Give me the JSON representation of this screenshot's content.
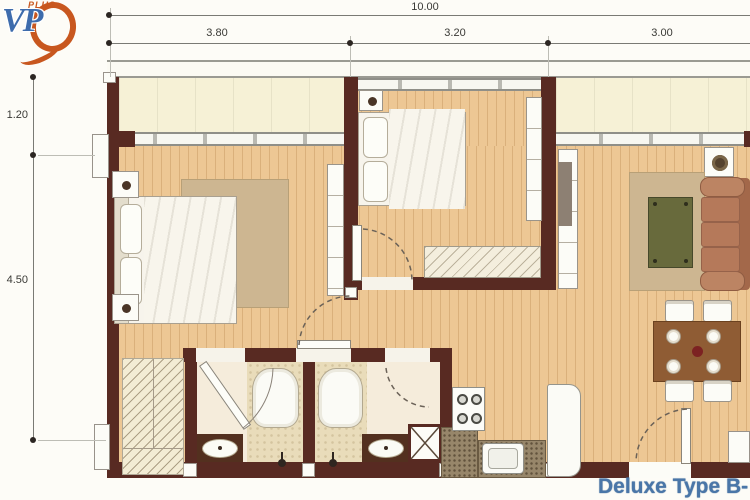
{
  "logo": {
    "vp_text": "VP",
    "plus_text": "PLUS"
  },
  "plan_title": "Deluxe Type B-",
  "dimensions": {
    "overall_width": "10.00",
    "top_segments": [
      "3.80",
      "3.20",
      "3.00"
    ],
    "left_segments": [
      "1.20",
      "4.50"
    ]
  },
  "colors": {
    "wall": "#582a22",
    "wood": "#edc794",
    "balcony": "#f6f1d6",
    "rug": "#cdb691",
    "sofa": "#b5795a",
    "title_blue": "#4a76a8",
    "logo_blue": "#3e6cac",
    "logo_orange": "#c8571f"
  }
}
